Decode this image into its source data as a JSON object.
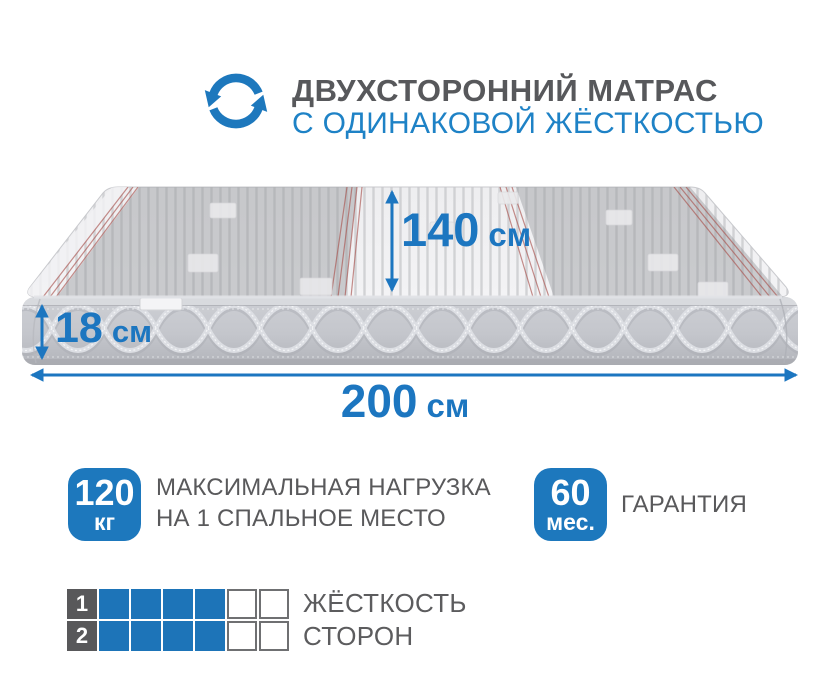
{
  "header": {
    "icon": "rotate-arrows-icon",
    "line1": "ДВУХСТОРОННИЙ МАТРАС",
    "line2": "С ОДИНАКОВОЙ ЖЁСТКОСТЬЮ"
  },
  "dimensions": {
    "depth": {
      "value": "140",
      "unit": "см"
    },
    "height": {
      "value": "18",
      "unit": "см"
    },
    "length": {
      "value": "200",
      "unit": "см"
    }
  },
  "features": [
    {
      "badge_value": "120",
      "badge_unit": "кг",
      "text_line1": "МАКСИМАЛЬНАЯ НАГРУЗКА",
      "text_line2": "НА 1 СПАЛЬНОЕ МЕСТО"
    },
    {
      "badge_value": "60",
      "badge_unit": "мес.",
      "text_line1": "ГАРАНТИЯ",
      "text_line2": ""
    }
  ],
  "firmness": {
    "rows": [
      {
        "index": "1",
        "filled": 4,
        "total": 6
      },
      {
        "index": "2",
        "filled": 4,
        "total": 6
      }
    ],
    "label_line1": "ЖЁСТКОСТЬ",
    "label_line2": "СТОРОН"
  },
  "colors": {
    "accent": "#1c76c0",
    "badge": "#1d78bd",
    "dark_text": "#58585a",
    "square_blue": "#1d74b8",
    "square_border": "#6f7072"
  }
}
